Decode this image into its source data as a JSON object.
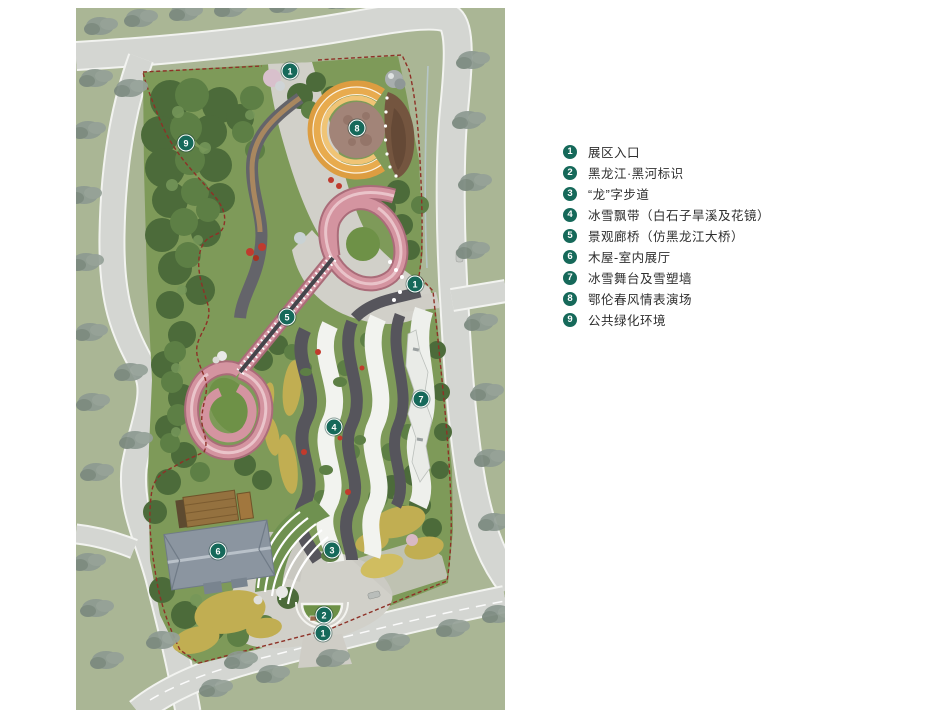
{
  "legend": {
    "items": [
      {
        "number": "1",
        "label": "展区入口"
      },
      {
        "number": "2",
        "label": "黑龙江·黑河标识"
      },
      {
        "number": "3",
        "label": "“龙”字步道"
      },
      {
        "number": "4",
        "label": "冰雪飘带（白石子旱溪及花镜）"
      },
      {
        "number": "5",
        "label": "景观廊桥（仿黑龙江大桥）"
      },
      {
        "number": "6",
        "label": "木屋-室内展厅"
      },
      {
        "number": "7",
        "label": "冰雪舞台及雪塑墙"
      },
      {
        "number": "8",
        "label": "鄂伦春风情表演场"
      },
      {
        "number": "9",
        "label": "公共绿化环境"
      }
    ]
  },
  "map": {
    "markers": [
      {
        "number": "1",
        "x": 290,
        "y": 71,
        "label": "展区入口"
      },
      {
        "number": "8",
        "x": 357,
        "y": 128,
        "label": "鄂伦春风情表演场"
      },
      {
        "number": "9",
        "x": 186,
        "y": 143,
        "label": "公共绿化环境"
      },
      {
        "number": "1",
        "x": 415,
        "y": 284,
        "label": "展区入口"
      },
      {
        "number": "5",
        "x": 287,
        "y": 317,
        "label": "景观廊桥（仿黑龙江大桥）"
      },
      {
        "number": "7",
        "x": 421,
        "y": 399,
        "label": "冰雪舞台及雪塑墙"
      },
      {
        "number": "4",
        "x": 334,
        "y": 427,
        "label": "冰雪飘带（白石子旱溪及花镜）"
      },
      {
        "number": "3",
        "x": 332,
        "y": 550,
        "label": "“龙”字步道"
      },
      {
        "number": "6",
        "x": 218,
        "y": 551,
        "label": "木屋-室内展厅"
      },
      {
        "number": "2",
        "x": 324,
        "y": 615,
        "label": "黑龙江·黑河标识"
      },
      {
        "number": "1",
        "x": 323,
        "y": 633,
        "label": "展区入口"
      }
    ],
    "palette": {
      "marker_green": "#16695a",
      "boundary_red": "#8e3127",
      "ribbon_pink": "#d494a0",
      "stage_orange": "#e8ab4e",
      "lawn_green": "#7e9a59",
      "tree_green": "#4c6b3a",
      "road_gray": "#d4d6d2",
      "map_green": "#aab695",
      "page_bg": "#ffffff"
    }
  }
}
